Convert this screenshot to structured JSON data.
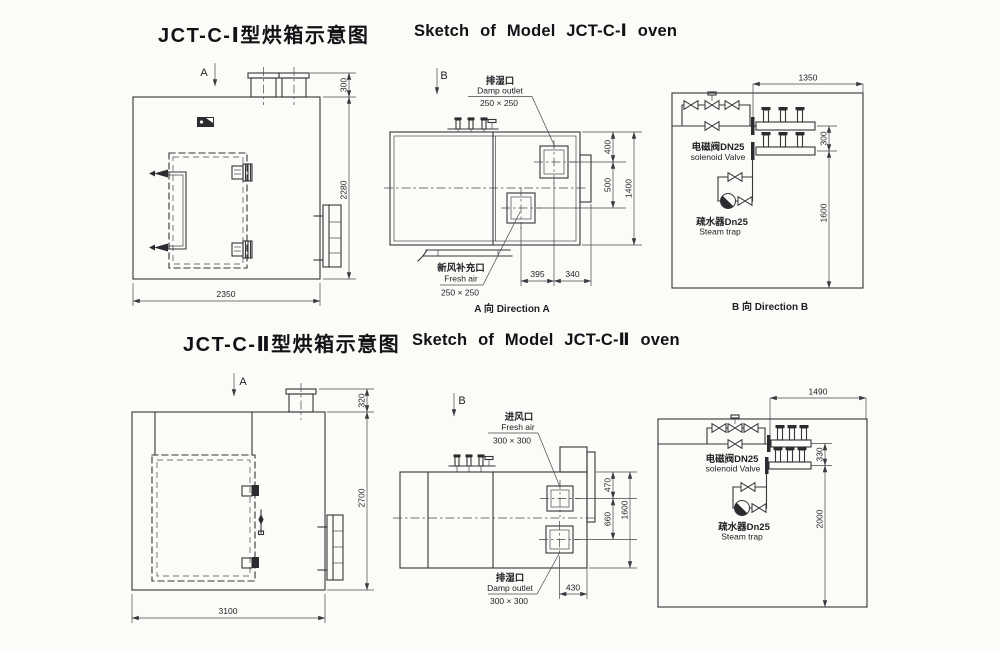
{
  "page": {
    "background": "#fbfbf8",
    "ink": "#34343a"
  },
  "oven1": {
    "title_cn": "JCT-C-Ⅰ型烘箱示意图",
    "title_en": "Sketch of Model JCT-C-Ⅰ oven",
    "front": {
      "view_label": "A",
      "dims": {
        "vent_height": "300",
        "body_height": "2280",
        "width": "2350"
      }
    },
    "plan": {
      "view_label": "B",
      "damp_outlet": {
        "cn": "排湿口",
        "en": "Damp outlet",
        "size": "250 × 250"
      },
      "fresh_air": {
        "cn": "新风补充口",
        "en": "Fresh air",
        "size": "250 × 250"
      },
      "dims": {
        "to_damp": "400",
        "damp_to_fresh": "500",
        "overall": "1400",
        "fresh_x": "395",
        "edge_x": "340"
      },
      "caption": "A 向 Direction A"
    },
    "piping": {
      "dims": {
        "width": "1350",
        "pipe_gap": "300",
        "height": "1600"
      },
      "solenoid_cn": "电磁阀DN25",
      "solenoid_en": "solenoid Valve",
      "trap_cn": "疏水器Dn25",
      "trap_en": "Steam trap",
      "caption": "B 向 Direction B"
    }
  },
  "oven2": {
    "title_cn": "JCT-C-Ⅱ型烘箱示意图",
    "title_en": "Sketch of Model JCT-C-Ⅱ oven",
    "front": {
      "view_label": "A",
      "dims": {
        "vent_height": "320",
        "body_height": "2700",
        "width": "3100"
      }
    },
    "plan": {
      "view_label": "B",
      "fresh_air": {
        "cn": "进风口",
        "en": "Fresh air",
        "size": "300 × 300"
      },
      "damp_outlet": {
        "cn": "排湿口",
        "en": "Damp outlet",
        "size": "300 × 300"
      },
      "dims": {
        "to_fresh": "470",
        "fresh_to_damp": "660",
        "overall": "1600",
        "edge_x": "430"
      }
    },
    "piping": {
      "dims": {
        "width": "1490",
        "pipe_gap": "330",
        "height": "2000"
      },
      "solenoid_cn": "电磁阀DN25",
      "solenoid_en": "solenoid Valve",
      "trap_cn": "疏水器Dn25",
      "trap_en": "Steam trap"
    }
  }
}
